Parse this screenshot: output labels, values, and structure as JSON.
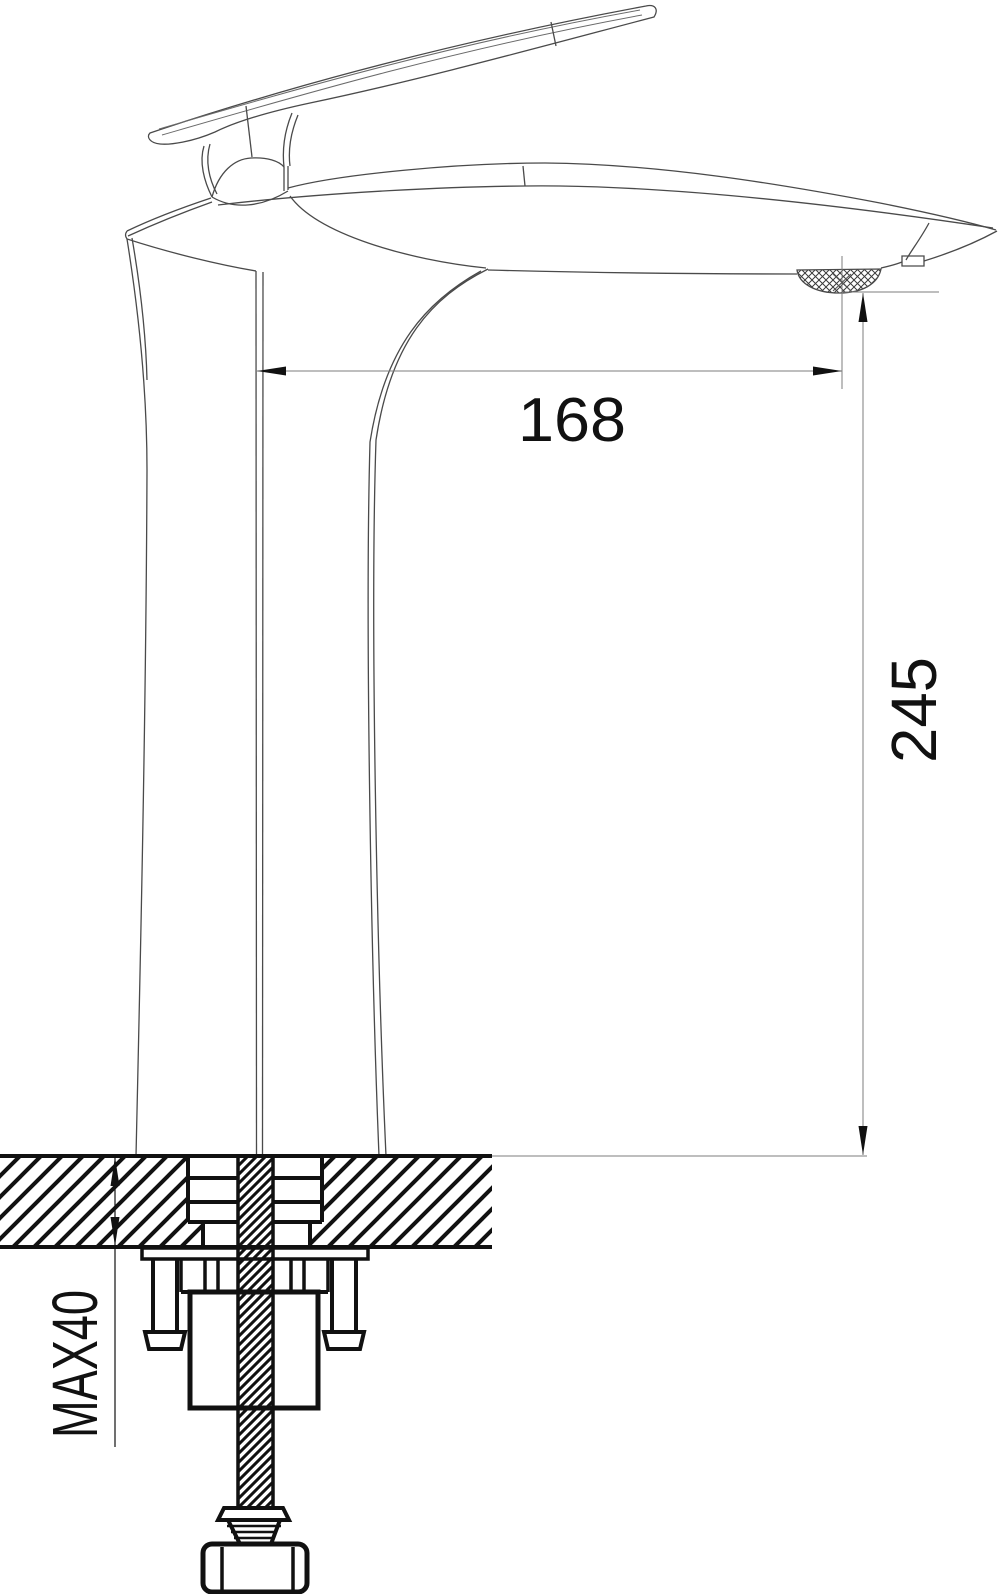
{
  "drawing": {
    "labels": {
      "spout_reach": "168",
      "outlet_height": "245",
      "max_deck_thickness": "MAX40"
    },
    "values": {
      "spout_reach_mm": 168,
      "outlet_height_mm": 245,
      "deck_thickness_max_mm": 40
    }
  },
  "colors": {
    "background": "#ffffff",
    "faucet_outline": "#4a4a4a",
    "dimension_line": "#7d7d7d",
    "ink": "#111111"
  }
}
